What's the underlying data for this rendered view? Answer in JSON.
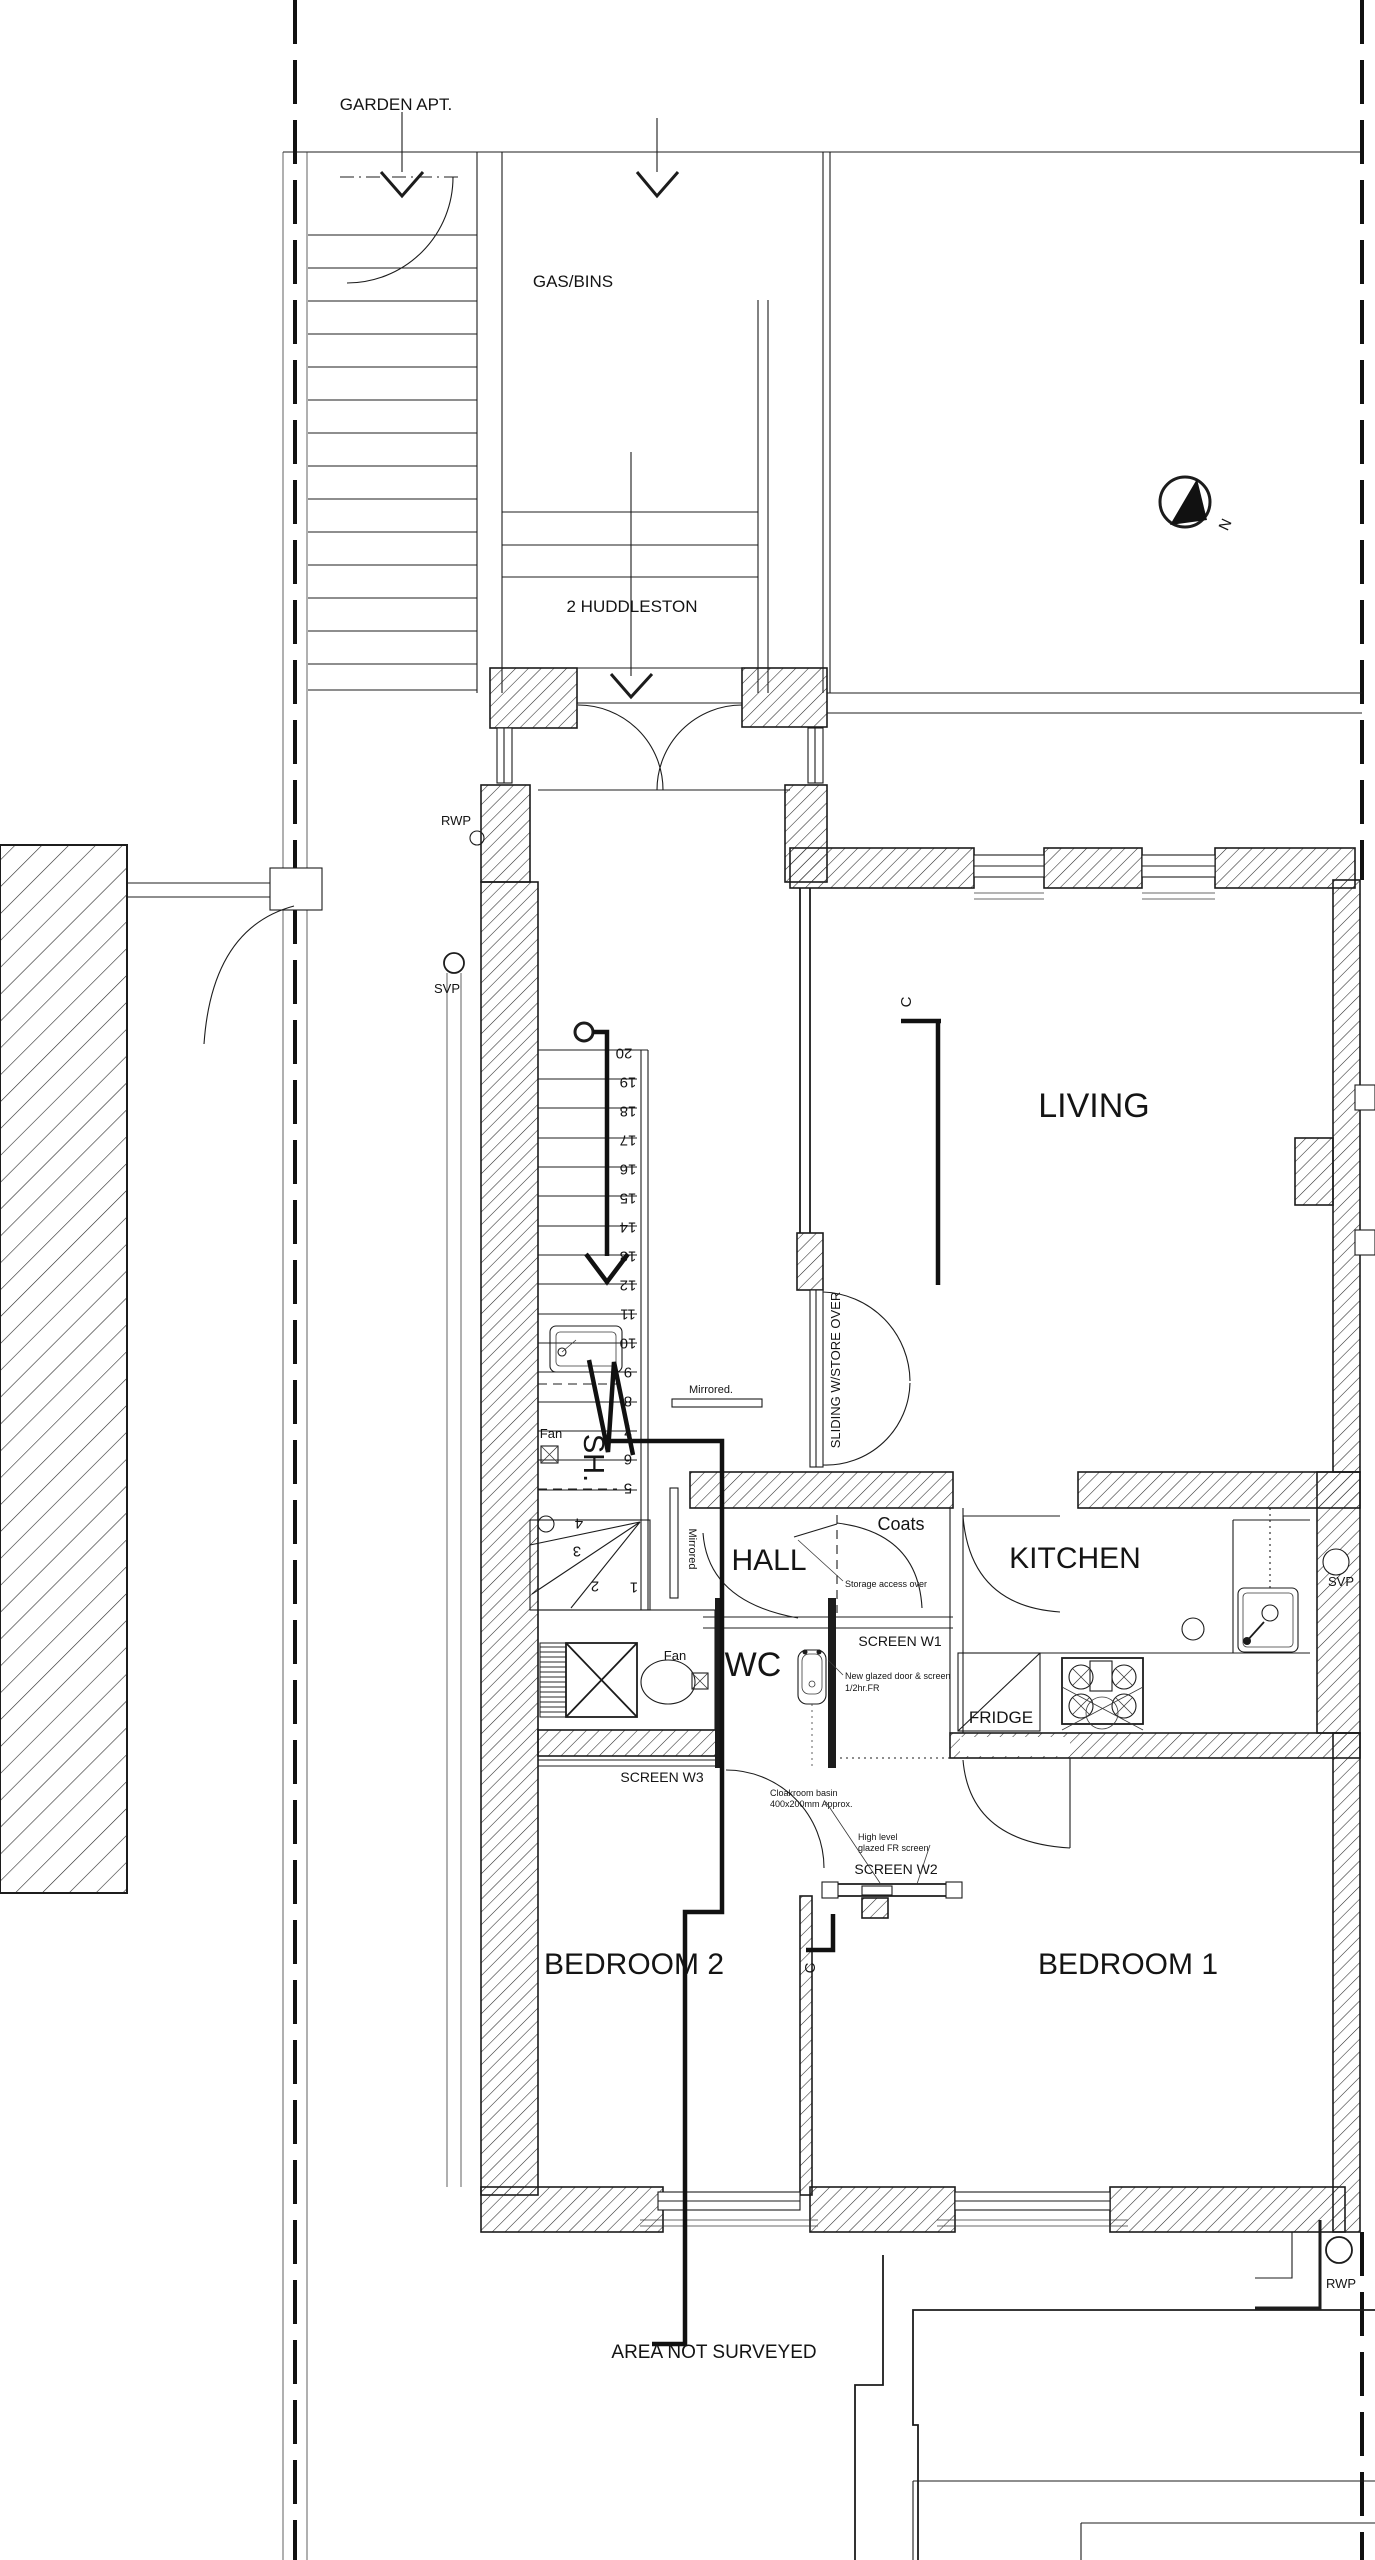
{
  "plan": {
    "colors": {
      "line": "#1c1c1c",
      "background": "#ffffff"
    },
    "context": {
      "garden_apt_label": "GARDEN APT.",
      "gas_bins_label": "GAS/BINS",
      "address_label": "2 HUDDLESTON",
      "area_not_surveyed_label": "AREA NOT SURVEYED"
    },
    "rooms": {
      "living": "LIVING",
      "kitchen": "KITCHEN",
      "hall": "HALL",
      "wc": "WC",
      "shower": "SH.",
      "coats": "Coats",
      "bedroom1": "BEDROOM 1",
      "bedroom2": "BEDROOM 2"
    },
    "plumbing": {
      "rwp_top": "RWP",
      "svp_left": "SVP",
      "svp_right": "SVP",
      "rwp_bottom": "RWP"
    },
    "fixtures": {
      "fridge": "FRIDGE",
      "fan_shower": "Fan",
      "fan_lobby": "Fan"
    },
    "joinery": {
      "mirrored_upper": "Mirrored.",
      "mirrored_lower": "Mirrored",
      "sliding_store": "SLIDING W/STORE OVER",
      "screen_w1": "SCREEN W1",
      "screen_w2": "SCREEN W2",
      "screen_w3": "SCREEN W3"
    },
    "notes": {
      "storage_access": "Storage access over",
      "glazed_line1": "New glazed door & screen",
      "glazed_line2": "1/2hr.FR",
      "cloakroom_line1": "Cloakroom basin",
      "cloakroom_line2": "400x200mm Approx.",
      "highlevel_line1": "High level",
      "highlevel_line2": "glazed FR screen"
    },
    "markers": {
      "north": "N",
      "section_top": "C",
      "section_bottom": "C"
    },
    "stairs": {
      "tread_numbers": [
        "1",
        "2",
        "3",
        "4",
        "5",
        "6",
        "7",
        "8",
        "9",
        "10",
        "11",
        "12",
        "13",
        "14",
        "15",
        "16",
        "17",
        "18",
        "19",
        "20"
      ]
    }
  }
}
